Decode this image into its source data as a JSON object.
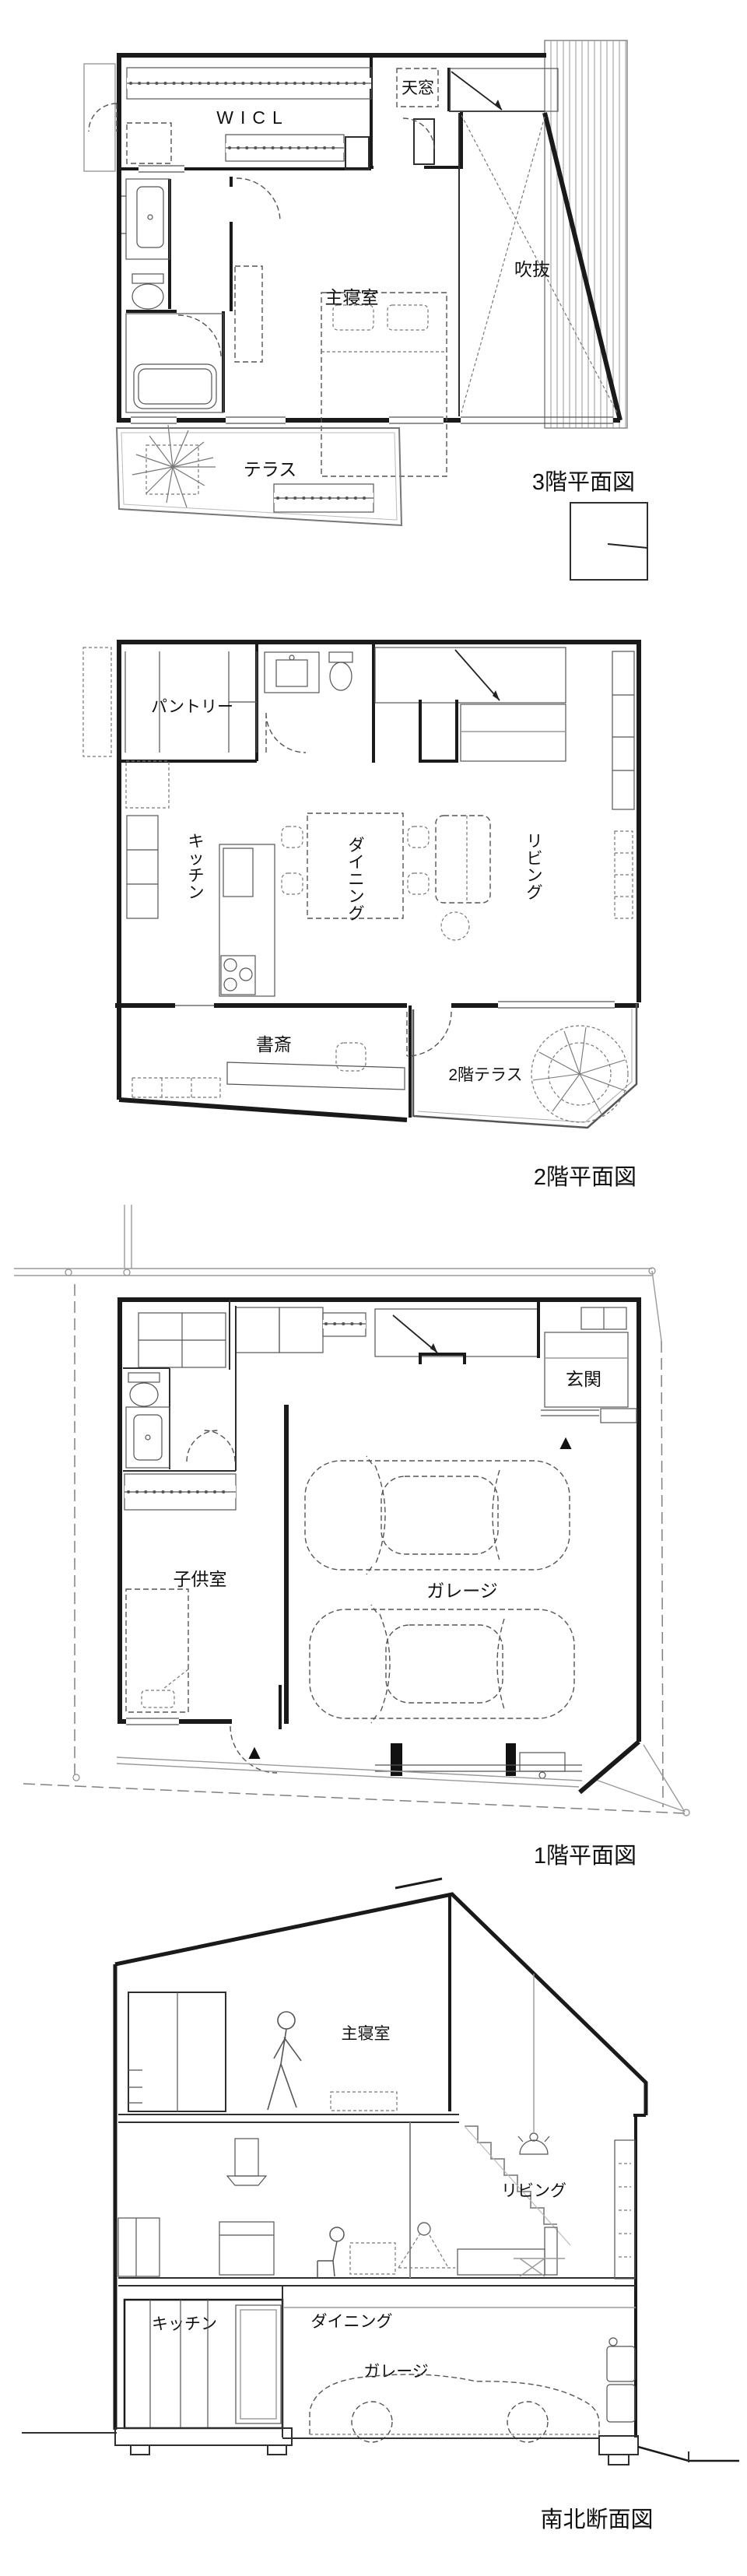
{
  "colors": {
    "wall": "#1a1a1a",
    "thin_line": "#555555",
    "gray_line": "#9a9a9a",
    "text": "#111111",
    "background": "#ffffff"
  },
  "floor3": {
    "title": "3階平面図",
    "rooms": {
      "wicl": "WICL",
      "skylight": "天窓",
      "master_bedroom": "主寝室",
      "void_space": "吹抜",
      "terrace": "テラス"
    }
  },
  "floor2": {
    "title": "2階平面図",
    "rooms": {
      "pantry": "パントリー",
      "kitchen": "キッチン",
      "dining": "ダイニング",
      "living": "リビング",
      "study": "書斎",
      "terrace": "2階テラス"
    }
  },
  "floor1": {
    "title": "1階平面図",
    "rooms": {
      "entrance": "玄関",
      "kids_room": "子供室",
      "garage": "ガレージ"
    },
    "markers": {
      "entrance_marker": "▲",
      "service_marker": "▲"
    }
  },
  "section": {
    "title": "南北断面図",
    "rooms": {
      "master_bedroom": "主寝室",
      "kitchen": "キッチン",
      "dining": "ダイニング",
      "living": "リビング",
      "garage": "ガレージ"
    }
  }
}
